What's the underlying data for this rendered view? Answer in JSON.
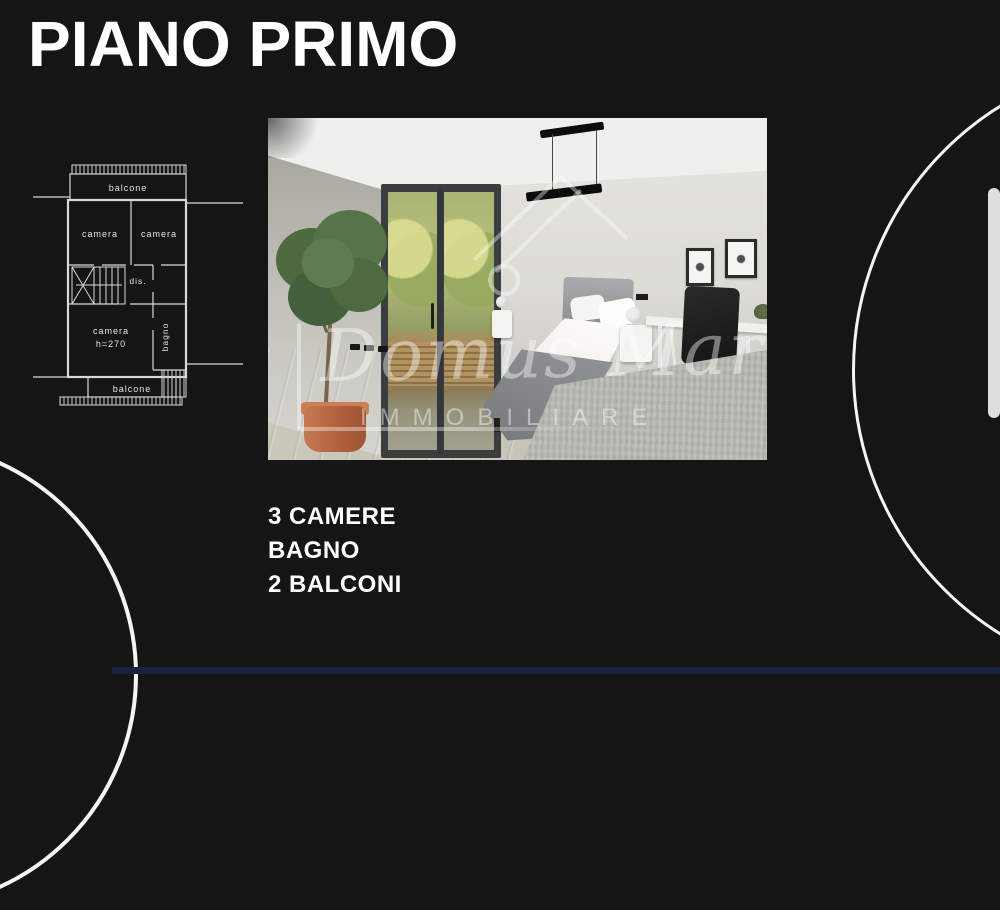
{
  "colors": {
    "background": "#151515",
    "text": "#ffffff"
  },
  "header": {
    "title": "PIANO PRIMO"
  },
  "floorplan": {
    "labels": {
      "balcone_top": "balcone",
      "camera_top_left": "camera",
      "camera_top_right": "camera",
      "dis": "dis.",
      "camera_main_line1": "camera",
      "camera_main_line2": "h=270",
      "bagno": "bagno",
      "balcone_bottom": "balcone"
    }
  },
  "photo": {
    "watermark_name": "Domus Mare'",
    "watermark_subtitle": "IMMOBILIARE"
  },
  "features": {
    "lines": [
      "3 CAMERE",
      "BAGNO",
      "2 BALCONI"
    ]
  }
}
